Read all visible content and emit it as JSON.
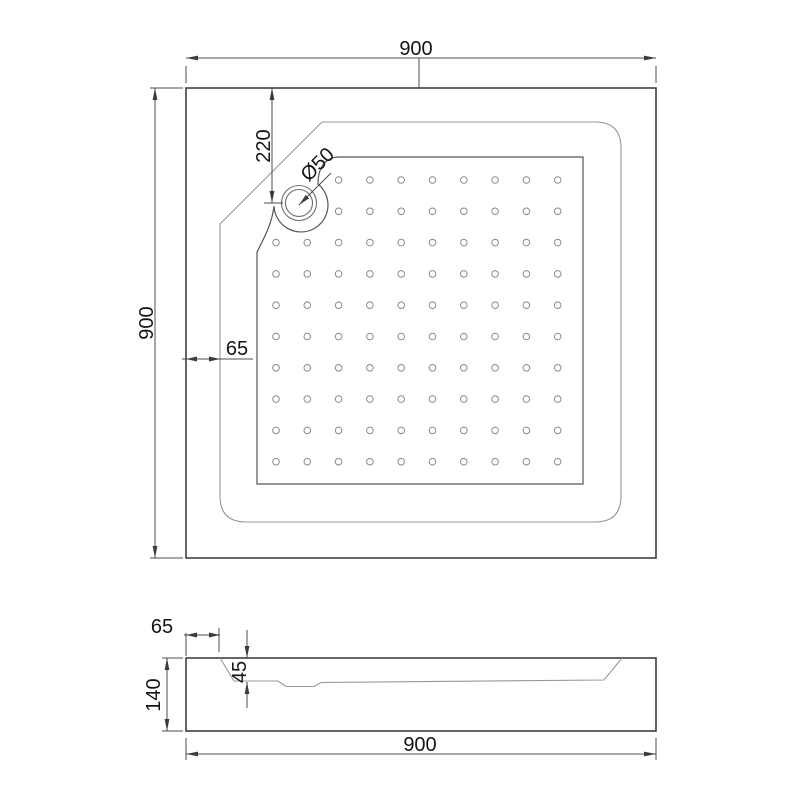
{
  "drawing": {
    "views": [
      "top view",
      "section view"
    ]
  },
  "top_view": {
    "width_label": "900",
    "height_label": "900",
    "drain_offset_label": "220",
    "drain_diameter_label": "Ø50",
    "rim_width_label": "65",
    "dot_grid": {
      "rows": 10,
      "cols": 10,
      "cut_rows": 2,
      "cut_cols": 2
    }
  },
  "section_view": {
    "rim_width_label": "65",
    "basin_depth_label": "45",
    "total_height_label": "140",
    "width_label": "900"
  },
  "colors": {
    "outline": "#3f3f3f",
    "edge_line": "#565656",
    "thin_line": "#979797",
    "drain_line": "#6e6e6e",
    "dot_line": "#8a8a8a",
    "dimension_line": "#4c4c4c",
    "text": "#141414",
    "background": "#ffffff"
  }
}
